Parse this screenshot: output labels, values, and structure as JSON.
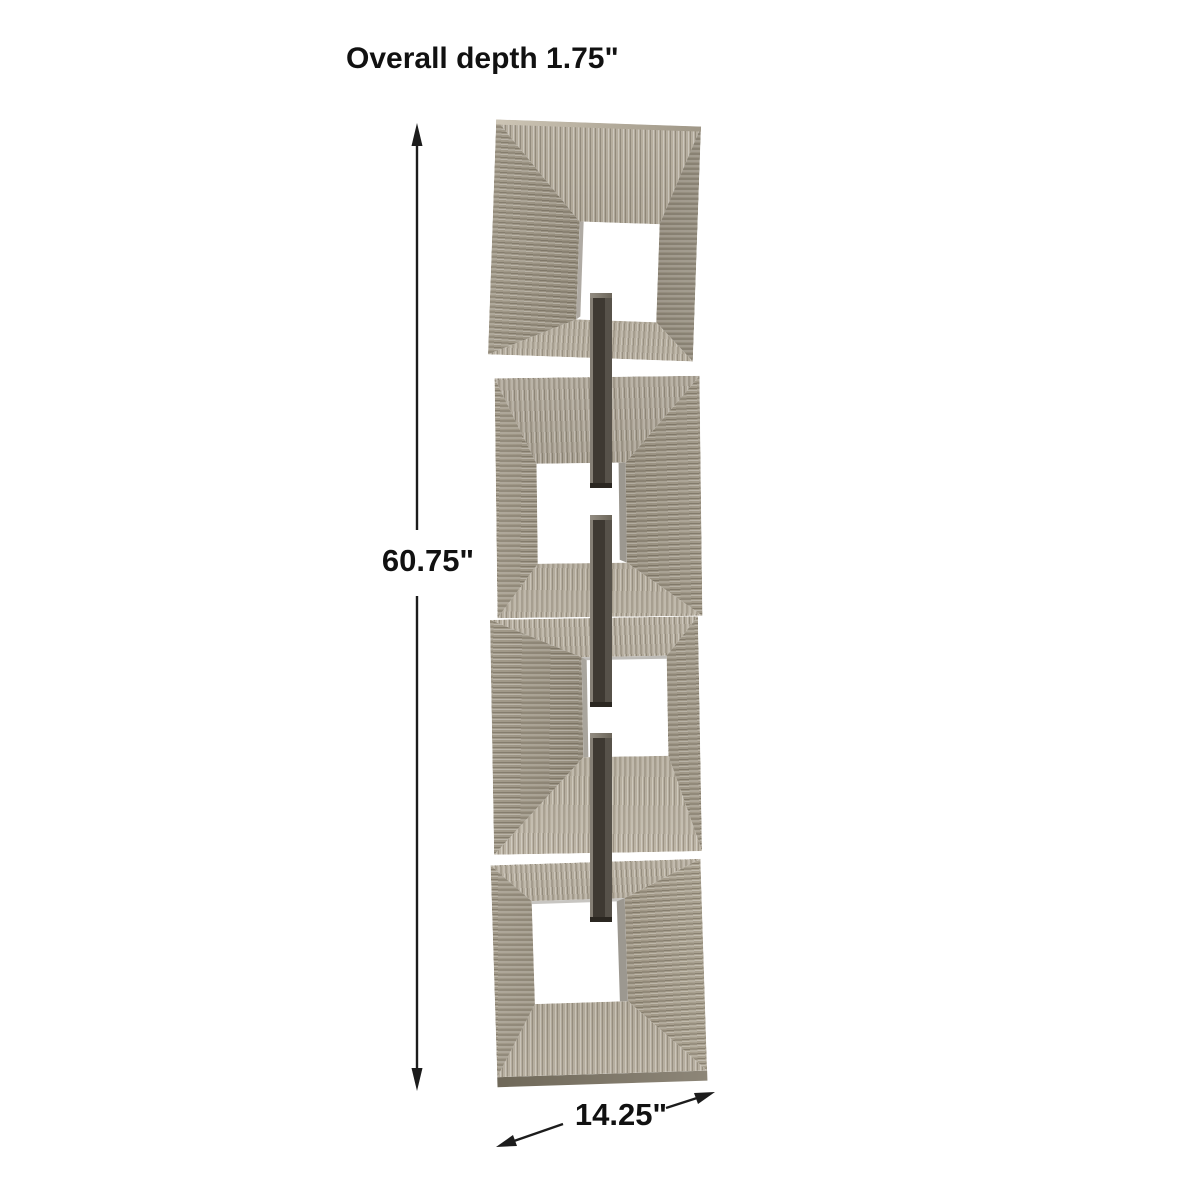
{
  "diagram": {
    "type": "product-dimension-diagram",
    "subject": "linked-squares-metal-wall-art",
    "artwork": {
      "panel_count": 4,
      "link_bar_segments": 3
    },
    "labels": {
      "depth": "Overall depth 1.75\"",
      "height": "60.75\"",
      "width": "14.25\""
    }
  },
  "colors": {
    "background": "#ffffff",
    "dimension-line": "#1c1c1c",
    "label-text": "#111111",
    "panel-finish-light": "#b7afa0",
    "panel-finish-mid": "#a29a8a",
    "panel-finish-dark": "#837b6b",
    "link-bar-dark": "#3e3932",
    "link-bar-highlight": "#857f75"
  }
}
